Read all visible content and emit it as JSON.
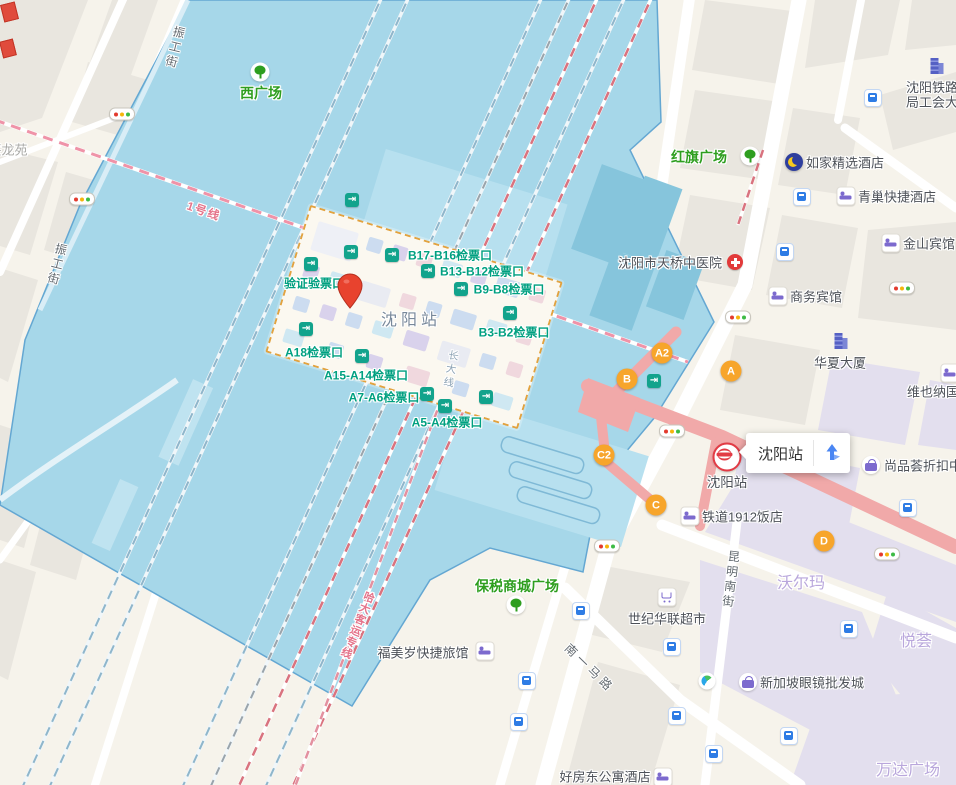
{
  "infobox": {
    "title": "沈阳站"
  },
  "station": {
    "name": "沈阳站",
    "rail_label": "长大线",
    "verify_gate": "验证验票口",
    "gates": {
      "b17": "B17-B16检票口",
      "b13": "B13-B12检票口",
      "b9": "B9-B8检票口",
      "b3": "B3-B2检票口",
      "a18": "A18检票口",
      "a15": "A15-A14检票口",
      "a7": "A7-A6检票口",
      "a5": "A5-A4检票口"
    }
  },
  "metro": {
    "station_label": "沈阳站",
    "line1": "1号线",
    "exits": {
      "a2": "A2",
      "b": "B",
      "a": "A",
      "c2": "C2",
      "c": "C",
      "d": "D"
    }
  },
  "rail": {
    "hada_line": "哈大客运专线"
  },
  "streets": {
    "zhengong_top": "振工街",
    "zhengong_left": "振工街",
    "nanyi": "南一马路",
    "kunming": "昆明南街"
  },
  "areas": {
    "west_plaza": "西广场",
    "hongqi_plaza": "红旗广场",
    "xinglongyuan": "兴龙苑",
    "walmart": "沃尔玛",
    "yuehui": "悦荟",
    "wanda": "万达广场",
    "baoshui_plaza": "保税商城广场"
  },
  "pois": {
    "railway_bureau_l1": "沈阳铁路",
    "railway_bureau_l2": "局工会大厦",
    "rujia_hotel": "如家精选酒店",
    "qingchao_hotel": "青巢快捷酒店",
    "jinshan_hotel": "金山宾馆",
    "shangwu_hotel": "商务宾馆",
    "tianqiao_hospital": "沈阳市天桥中医院",
    "huaxia_tower": "华夏大厦",
    "vienna_hotel": "维也纳国际",
    "shangpinhui": "尚品荟折扣中心",
    "tiedao_hotel": "铁道1912饭店",
    "shiji_supermarket": "世纪华联超市",
    "xinjiapo_glasses": "新加坡眼镜批发城",
    "fumeisui_hotel": "福美岁快捷旅馆",
    "haofangdong_hotel": "好房东公寓酒店"
  },
  "colors": {
    "aoi_blue": "#a6d7e9",
    "exit_orange": "#f7a52b",
    "gate_teal": "#12a38c",
    "park_green": "#2e9e1f",
    "overpass_pink": "#f1a9a9",
    "pin_red": "#e8432e",
    "route_blue": "#4a86f3",
    "area_label_purple": "#b9a7dc"
  }
}
